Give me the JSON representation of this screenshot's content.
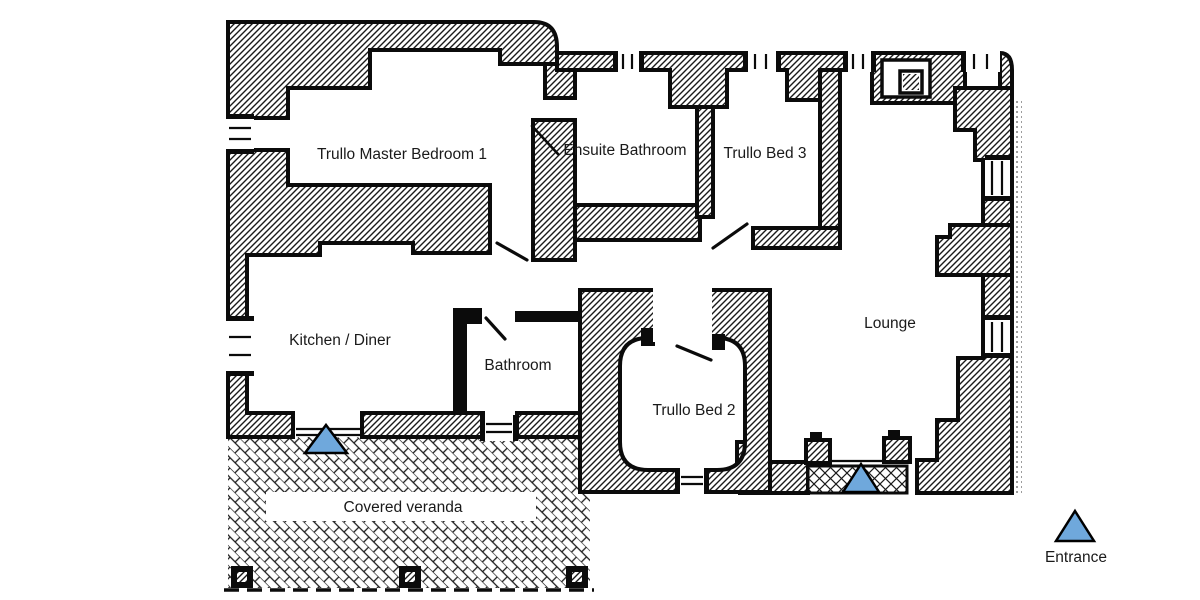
{
  "diagram": {
    "type": "floor-plan",
    "subject": "Trullo house ground floor"
  },
  "rooms": [
    {
      "id": "master-bedroom",
      "label": "Trullo Master Bedroom 1"
    },
    {
      "id": "ensuite-bathroom",
      "label": "Ensuite Bathroom"
    },
    {
      "id": "trullo-bed-3",
      "label": "Trullo Bed 3"
    },
    {
      "id": "kitchen-diner",
      "label": "Kitchen / Diner"
    },
    {
      "id": "bathroom",
      "label": "Bathroom"
    },
    {
      "id": "trullo-bed-2",
      "label": "Trullo Bed 2"
    },
    {
      "id": "lounge",
      "label": "Lounge"
    },
    {
      "id": "covered-veranda",
      "label": "Covered veranda"
    }
  ],
  "legend": {
    "entrance_label": "Entrance"
  },
  "markers": {
    "entrance_symbol": "triangle",
    "entrance_count_on_plan": 2
  },
  "colors": {
    "entrance_fill": "#6FA8DC",
    "entrance_border": "#000000",
    "wall_ink": "#0b0b0b",
    "background": "#ffffff"
  }
}
